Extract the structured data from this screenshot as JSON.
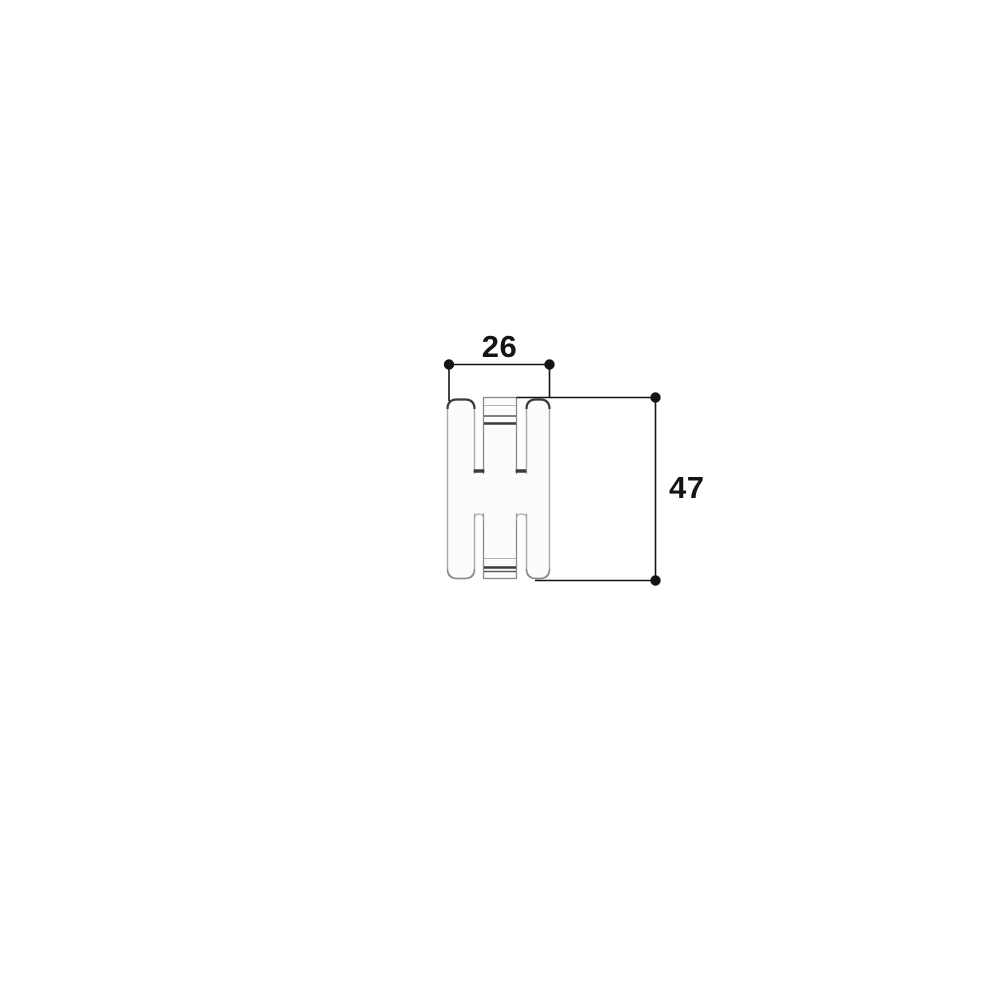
{
  "drawing": {
    "title": "part-profile-dimension-drawing",
    "colors": {
      "background": "#ffffff",
      "part-fill": "#fcfcfc",
      "outline-light": "#a8a8a8",
      "outline-medium": "#8a8a8a",
      "outline-dark": "#3b3b3b",
      "dimension": "#141414"
    },
    "dimensions": {
      "width": {
        "value": "26"
      },
      "height": {
        "value": "47"
      }
    }
  }
}
